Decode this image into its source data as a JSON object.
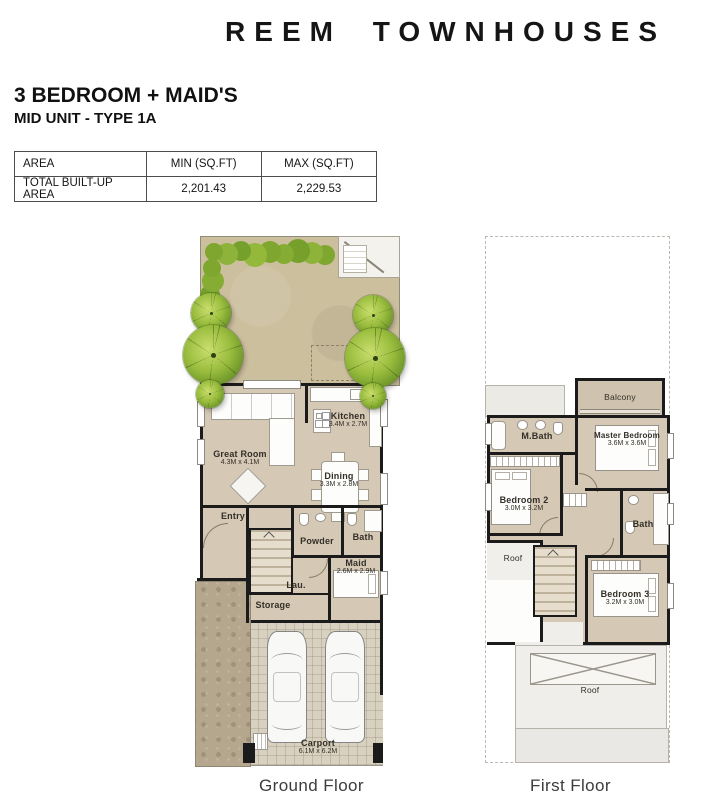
{
  "header": {
    "brand": "REEM TOWNHOUSES",
    "unit_title": "3 BEDROOM + MAID'S",
    "unit_subtitle": "MID UNIT - TYPE 1A"
  },
  "area_table": {
    "col_area": "AREA",
    "col_min": "MIN (SQ.FT)",
    "col_max": "MAX (SQ.FT)",
    "row_label": "TOTAL BUILT-UP AREA",
    "min_value": "2,201.43",
    "max_value": "2,229.53"
  },
  "ground_floor": {
    "caption": "Ground Floor",
    "rooms": {
      "great_room": {
        "name": "Great Room",
        "dims": "4.3M x 4.1M"
      },
      "kitchen": {
        "name": "Kitchen",
        "dims": "3.4M x 2.7M"
      },
      "dining": {
        "name": "Dining",
        "dims": "3.3M x 2.8M"
      },
      "entry": {
        "name": "Entry"
      },
      "powder": {
        "name": "Powder"
      },
      "bath": {
        "name": "Bath"
      },
      "maid": {
        "name": "Maid",
        "dims": "2.6M x 2.9M"
      },
      "laundry": {
        "name": "Lau."
      },
      "storage": {
        "name": "Storage"
      },
      "carport": {
        "name": "Carport",
        "dims": "6.1M x 6.2M"
      }
    }
  },
  "first_floor": {
    "caption": "First Floor",
    "rooms": {
      "balcony": {
        "name": "Balcony"
      },
      "m_bath": {
        "name": "M.Bath"
      },
      "master_bedroom": {
        "name": "Master Bedroom",
        "dims": "3.6M x 3.6M"
      },
      "bedroom_2": {
        "name": "Bedroom 2",
        "dims": "3.0M x 3.2M"
      },
      "bath": {
        "name": "Bath"
      },
      "roof_left": {
        "name": "Roof"
      },
      "bedroom_3": {
        "name": "Bedroom 3",
        "dims": "3.2M x 3.0M"
      },
      "roof": {
        "name": "Roof"
      }
    }
  },
  "colors": {
    "wall": "#1b1b1b",
    "interior_floor": "#d5c8b5",
    "garden_ground": "#ccbf9e",
    "tree_green": "#8fb636",
    "roof_gray": "#efeeea",
    "carport_floor": "#d8d1c0",
    "side_yard": "#b5a78d",
    "text": "#1a1a1a"
  }
}
